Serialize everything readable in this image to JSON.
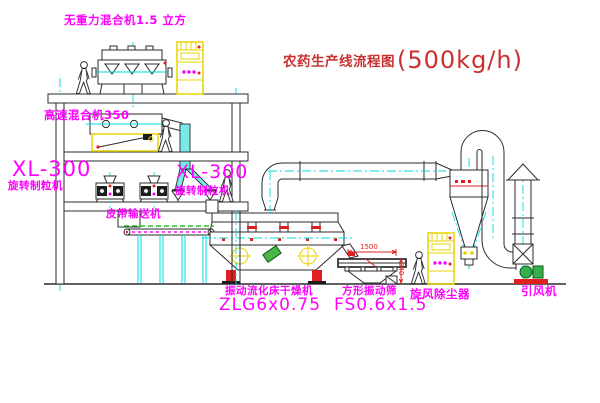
{
  "title": {
    "text": "农药生产线流程图",
    "capacity": "(500kg/h)"
  },
  "equipment": {
    "no_gravity_mixer": {
      "label": "无重力混合机1.5 立方"
    },
    "high_speed_mixer": {
      "label": "高速混合机350"
    },
    "granulator_left": {
      "model": "XL-300",
      "name": "旋转制粒机"
    },
    "granulator_right": {
      "model": "XL-300",
      "name": "旋转制粒机"
    },
    "belt_conveyor": {
      "label": "皮带输送机"
    },
    "fluid_bed_dryer": {
      "name": "振动流化床干燥机",
      "model": "ZLG6x0.75"
    },
    "vibrating_sieve": {
      "name": "方形振动筛",
      "model": "FS0.6x1.5",
      "dim_length": "1500",
      "dim_height": "340"
    },
    "cyclone_dust_collector": {
      "label": "旋风除尘器"
    },
    "induced_draft_fan": {
      "label": "引风机"
    }
  },
  "colors": {
    "label_magenta": "#ff00ff",
    "title_red": "#c93131",
    "centerline_cyan": "#00dcdc",
    "cabinet_yellow": "#e8d400",
    "accent_red": "#e02020",
    "accent_green": "#2fae2f"
  }
}
